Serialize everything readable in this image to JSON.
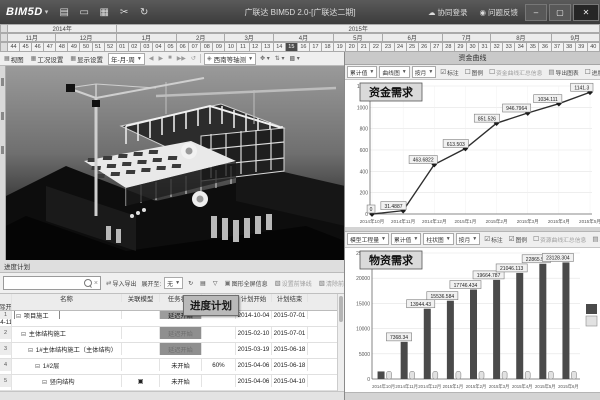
{
  "titlebar": {
    "logo": "BIM5D",
    "logo_caret": "▾",
    "icons": [
      {
        "name": "new-file-icon",
        "glyph": "▤"
      },
      {
        "name": "open-folder-icon",
        "glyph": "▭"
      },
      {
        "name": "save-icon",
        "glyph": "▦"
      },
      {
        "name": "tools-icon",
        "glyph": "✂"
      },
      {
        "name": "sync-icon",
        "glyph": "↻"
      }
    ],
    "title": "广联达 BIM5D 2.0-[广联达二期]",
    "login_icon": "☁",
    "login_label": "协同登录",
    "feedback_icon": "◉",
    "feedback_label": "问题反馈",
    "minimize": "–",
    "maximize": "▢",
    "close": "✕"
  },
  "timeline": {
    "years": [
      {
        "label": "2014年",
        "weeks": 9
      },
      {
        "label": "2015年",
        "weeks": 40
      }
    ],
    "months": [
      {
        "label": "11月",
        "weeks": 4
      },
      {
        "label": "12月",
        "weeks": 5
      },
      {
        "label": "1月",
        "weeks": 5
      },
      {
        "label": "2月",
        "weeks": 4
      },
      {
        "label": "3月",
        "weeks": 4
      },
      {
        "label": "4月",
        "weeks": 5
      },
      {
        "label": "5月",
        "weeks": 4
      },
      {
        "label": "6月",
        "weeks": 5
      },
      {
        "label": "7月",
        "weeks": 4
      },
      {
        "label": "8月",
        "weeks": 5
      },
      {
        "label": "9月",
        "weeks": 4
      }
    ],
    "weeks": [
      "44",
      "45",
      "46",
      "47",
      "48",
      "49",
      "50",
      "51",
      "52",
      "01",
      "02",
      "03",
      "04",
      "05",
      "06",
      "07",
      "08",
      "09",
      "10",
      "11",
      "12",
      "13",
      "14",
      "15",
      "16",
      "17",
      "18",
      "19",
      "20",
      "21",
      "22",
      "23",
      "24",
      "25",
      "26",
      "27",
      "28",
      "29",
      "30",
      "31",
      "32",
      "33",
      "34",
      "35",
      "36",
      "37",
      "38",
      "39",
      "40"
    ],
    "current_week_index": 23
  },
  "sim_toolbar": {
    "view": "视图",
    "condition": "工况设置",
    "display": "显示设置",
    "speed_value": "年-月-周",
    "playback": [
      "◀",
      "▶",
      "■",
      "▶▶",
      "↺"
    ],
    "camera_icon": "◈",
    "camera_value": "西南等轴测",
    "extra_tools": [
      "✥",
      "⇅",
      "▩"
    ]
  },
  "schedule": {
    "panel_title": "进度计划",
    "float_label": "进度计划",
    "toolbar": {
      "clear": "×",
      "import_export": "导入导出",
      "expand_label": "展开至:",
      "expand_value": "无",
      "refresh_icon": "↻",
      "print_icon": "▤",
      "filter_icon": "▽",
      "link_info": "图形全屏信息",
      "front_line_set": "设置前锋线",
      "front_line_clear": "清除前锋线"
    },
    "columns": [
      "名称",
      "关联模型",
      "任务状态",
      "",
      "计划开始",
      "计划结束",
      "实际开始"
    ],
    "rows": [
      {
        "num": "1",
        "indent": 0,
        "name": "项目施工",
        "model": "",
        "status": "延迟开始",
        "status_style": "delay",
        "extra": "",
        "plan_start": "2014-10-04",
        "plan_end": "2015-07-01",
        "actual_start": "2014-11-04",
        "name_boxed": true
      },
      {
        "num": "2",
        "indent": 1,
        "name": "主体结构施工",
        "model": "",
        "status": "延迟开始",
        "status_style": "dark",
        "extra": "",
        "plan_start": "2015-02-10",
        "plan_end": "2015-07-01",
        "actual_start": "",
        "name_boxed": false
      },
      {
        "num": "3",
        "indent": 2,
        "name": "1#主体结构施工（主体结构）",
        "model": "",
        "status": "延迟开始",
        "status_style": "dark",
        "extra": "",
        "plan_start": "2015-03-19",
        "plan_end": "2015-06-18",
        "actual_start": "",
        "name_boxed": false
      },
      {
        "num": "4",
        "indent": 3,
        "name": "1#2层",
        "model": "",
        "status": "未开始",
        "status_style": "none",
        "extra": "60%",
        "plan_start": "2015-04-06",
        "plan_end": "2015-06-18",
        "actual_start": "",
        "name_boxed": false
      },
      {
        "num": "5",
        "indent": 4,
        "name": "竖向结构",
        "model": "▣",
        "status": "未开始",
        "status_style": "none",
        "extra": "",
        "plan_start": "2015-04-06",
        "plan_end": "2015-04-10",
        "actual_start": "",
        "name_boxed": false
      }
    ]
  },
  "funds_panel": {
    "header": "资金曲线",
    "toolbar": {
      "dd1": "累计值",
      "dd2": "曲线图",
      "dd3": "按月",
      "cb_mark_icon": "☑",
      "cb_mark": "标注",
      "cb_legend_icon": "☐",
      "cb_legend": "图例",
      "cb_summary_icon": "☐",
      "summary": "资金曲线汇总信息",
      "export_icon": "▤",
      "export": "导出图表",
      "trailing": "进度"
    }
  },
  "materials_panel": {
    "toolbar": {
      "dd0": "模型工程量",
      "dd1": "累计值",
      "dd2": "柱状图",
      "dd3": "按月",
      "cb_mark_icon": "☑",
      "cb_mark": "标注",
      "cb_legend_icon": "☑",
      "cb_legend": "图例",
      "cb_summary_icon": "☐",
      "summary": "资源曲线汇总信息",
      "export_icon": "▤",
      "export": "导出图表"
    }
  },
  "chart_data": [
    {
      "type": "line",
      "title": "资金需求",
      "x": [
        "2014年10月",
        "2014年11月",
        "2014年12月",
        "2015年1月",
        "2015年2月",
        "2015年3月",
        "2015年4月",
        "2015年5月"
      ],
      "values": [
        0,
        31.49,
        463.68,
        613.5,
        851.53,
        946.8,
        1034.11,
        1141.3
      ],
      "labels": [
        "0",
        "31.4887",
        "463.6822",
        "613.503",
        "851.526",
        "946.7964",
        "1034.111",
        "1141.3"
      ],
      "ylim": [
        0,
        1200
      ],
      "yticks": [
        0,
        200,
        400,
        600,
        800,
        1000,
        1200
      ],
      "grid": true,
      "legend": "none",
      "line_color": "#2e2e2e"
    },
    {
      "type": "bar",
      "title": "物资需求",
      "x": [
        "2014年10月",
        "2014年11月",
        "2014年12月",
        "2015年1月",
        "2015年2月",
        "2015年3月",
        "2015年4月",
        "2015年5月",
        "2015年6月"
      ],
      "series": [
        {
          "name": "累计需求",
          "color": "#4a4a4a",
          "values": [
            1500,
            7368.34,
            13944.43,
            15536.584,
            17746.434,
            19664.787,
            21046.113,
            22865.56,
            23128.304
          ],
          "labels": [
            "",
            "7368.34",
            "13944.43",
            "15536.584",
            "17746.434",
            "19664.787",
            "21046.113",
            "22865.56",
            "23128.304"
          ]
        },
        {
          "name": "当期量",
          "color": "#e2e2e2",
          "values": [
            1500,
            1500,
            1500,
            1500,
            1500,
            1500,
            1500,
            1500,
            1500
          ],
          "labels": [
            "",
            "",
            "",
            "",
            "",
            "",
            "",
            "",
            ""
          ]
        }
      ],
      "ylim": [
        0,
        25000
      ],
      "yticks": [
        0,
        5000,
        10000,
        15000,
        20000,
        25000
      ],
      "grid": true,
      "legend": "right"
    }
  ]
}
